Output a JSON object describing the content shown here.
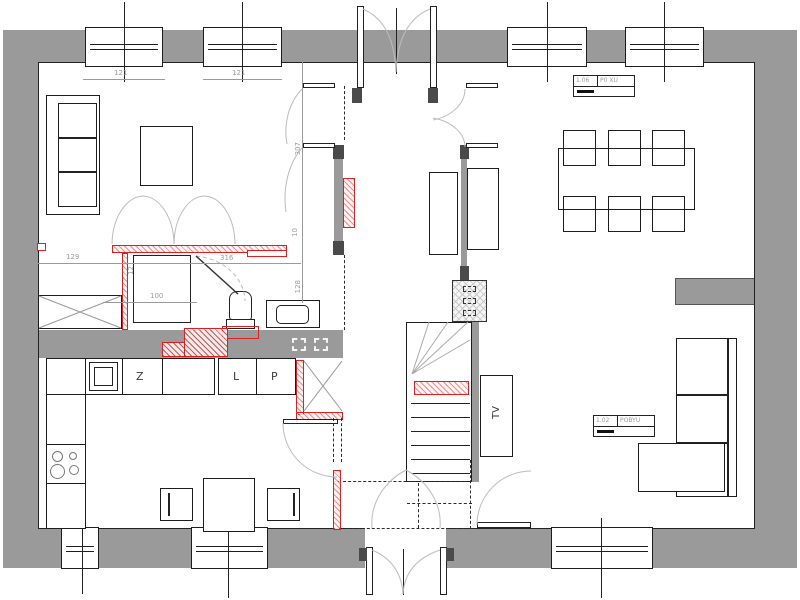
{
  "title": "floor-plan",
  "colors": {
    "wall": "#9a9a9a",
    "line": "#1d1d1d",
    "red": "#df1f1f",
    "dim_text": "#9b9b9b"
  },
  "dims": {
    "win_top_1": "121",
    "win_top_2": "121",
    "closet": "129",
    "wall_thk": "12",
    "hall": "316",
    "wc": "100",
    "v_door": "123",
    "v_hall": "307",
    "v_niche": "10",
    "v_wc": "128"
  },
  "kitchen": {
    "sink_label": "Z",
    "fridge_label": "L",
    "pantry_label": "P"
  },
  "living": {
    "tv_label": "TV"
  },
  "stamps": {
    "dining": {
      "no": "1.06",
      "name": "P0 XU"
    },
    "living": {
      "no": "1.02",
      "name": "POBYU"
    }
  }
}
